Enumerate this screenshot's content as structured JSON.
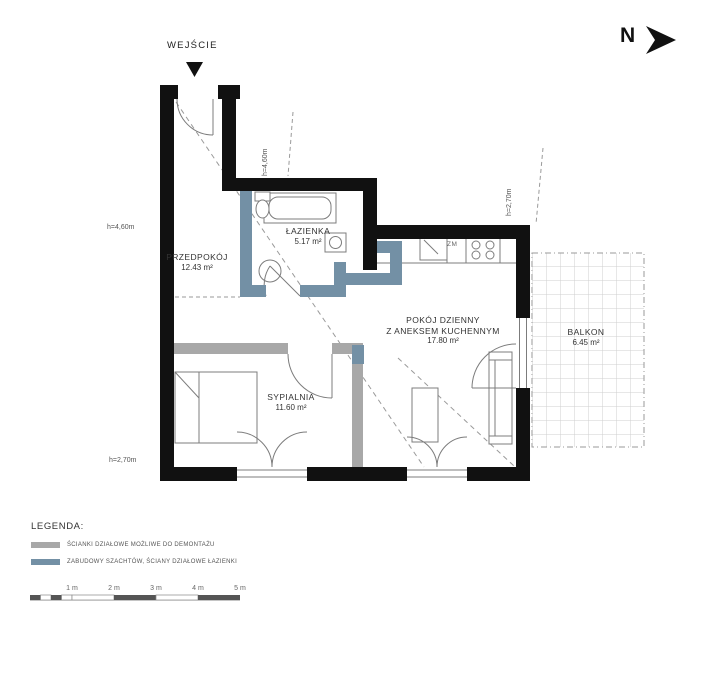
{
  "labels": {
    "entrance": "WEJŚCIE",
    "north": "N"
  },
  "rooms": {
    "hallway": {
      "name": "PRZEDPOKÓJ",
      "area": "12.43 m²"
    },
    "bathroom": {
      "name": "ŁAZIENKA",
      "area": "5.17 m²"
    },
    "living_room": {
      "name_line1": "POKÓJ DZIENNY",
      "name_line2": "Z ANEKSEM KUCHENNYM",
      "area": "17.80 m²"
    },
    "bedroom": {
      "name": "SYPIALNIA",
      "area": "11.60 m²"
    },
    "balcony": {
      "name": "BALKON",
      "area": "6.45 m²"
    }
  },
  "ceiling_heights": {
    "hallway": "h=4,60m",
    "bathroom_wall": "h=4,60m",
    "kitchen_wall": "h=2,70m",
    "bedroom_wall": "h=2,70m"
  },
  "kitchen": {
    "appliance_label": "ZM"
  },
  "legend": {
    "title": "LEGENDA:",
    "items": [
      {
        "label": "ŚCIANKI DZIAŁOWE MOŻLIWE DO DEMONTAŻU",
        "color": "#a8a8a8"
      },
      {
        "label": "ZABUDOWY SZACHTÓW, ŚCIANY DZIAŁOWE ŁAZIENKI",
        "color": "#7390a5"
      }
    ]
  },
  "scale_bar": {
    "labels": [
      "1 m",
      "2 m",
      "3 m",
      "4 m",
      "5 m"
    ]
  },
  "colors": {
    "exterior_wall": "#111111",
    "demountable_partition": "#a8a8a8",
    "shaft_bathroom_wall": "#7390a5"
  }
}
